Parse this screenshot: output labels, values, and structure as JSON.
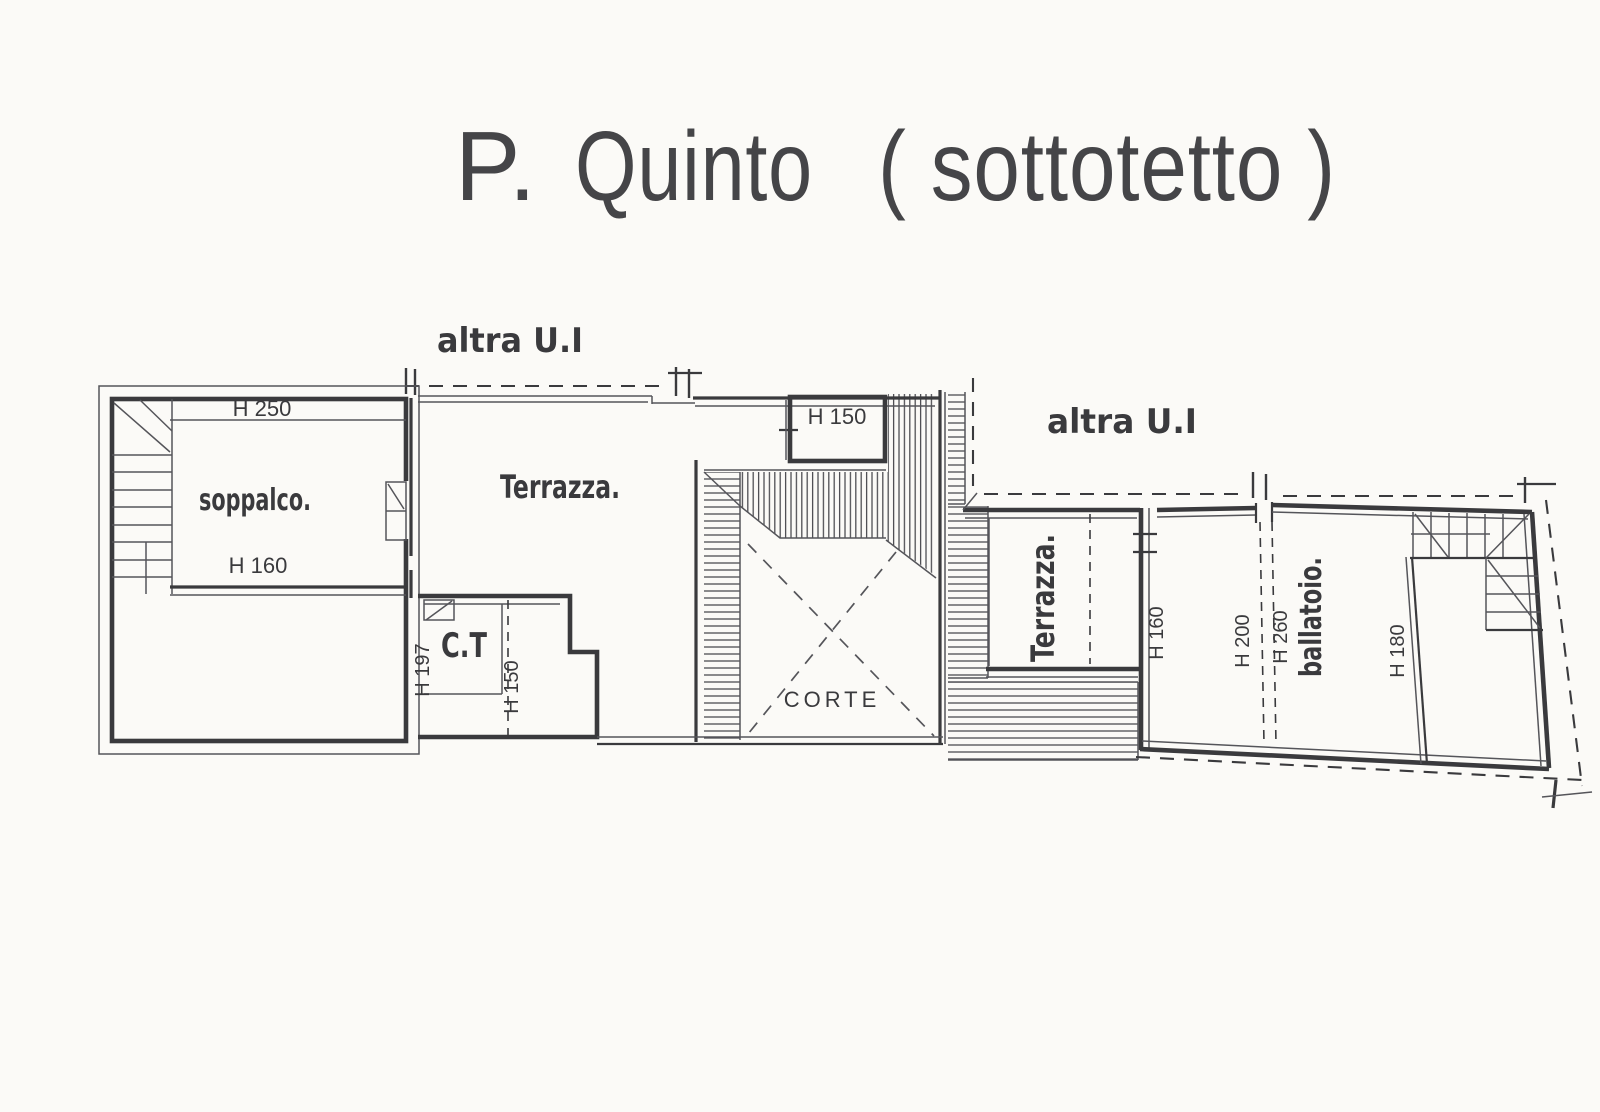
{
  "title": {
    "p": "P.",
    "quinto": "Quinto",
    "sottotetto": "( sottotetto )"
  },
  "labels": {
    "other_unit_left": "altra U.I",
    "other_unit_right": "altra U.I",
    "h250": "H 250",
    "soppalco": "soppalco.",
    "h160_left": "H 160",
    "terrazza_left": "Terrazza.",
    "ct": "C.T",
    "h197": "H 197",
    "h150_ct": "H 150",
    "h150_room": "H 150",
    "corte": "CORTE",
    "terrazza_right": "Terrazza.",
    "h160_right": "H 160",
    "h200": "H 200",
    "h260": "H 260",
    "ballatoio": "ballatoio.",
    "h180": "H 180"
  },
  "colors": {
    "paper": "#fbfaf7",
    "ink": "#3a3a3d",
    "ink_soft": "#55555a",
    "title_ink": "#454548"
  }
}
